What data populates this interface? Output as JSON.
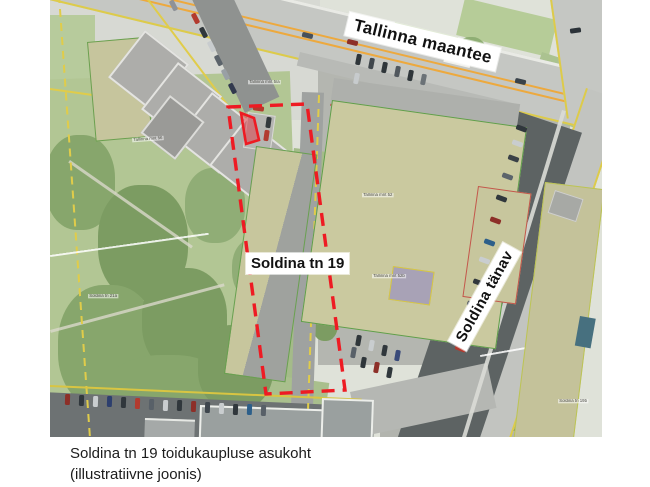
{
  "map": {
    "street_labels": {
      "tallinna_maantee": "Tallinna maantee",
      "soldina_tanav": "Soldina tänav"
    },
    "site_label": "Soldina tn 19",
    "tiny_labels": [
      {
        "text": "Tallinna mnt 5/a",
        "x": 198,
        "y": 80,
        "r": 0
      },
      {
        "text": "Tallinna mnt 56",
        "x": 82,
        "y": 138,
        "r": -4
      },
      {
        "text": "Tallinna mnt 52",
        "x": 312,
        "y": 193,
        "r": 0
      },
      {
        "text": "Tallinna mnt 52b",
        "x": 322,
        "y": 274,
        "r": 0
      },
      {
        "text": "Soldina tn 21a",
        "x": 38,
        "y": 294,
        "r": 0
      },
      {
        "text": "Soldina tn 19b",
        "x": 508,
        "y": 399,
        "r": 0
      }
    ],
    "annotation": {
      "outline_color": "#ee1b23",
      "outline_points": "178,107 257,104 295,390 216,394",
      "shop_points": "191,113 204,118 209,140 196,144",
      "shop_fill": "rgba(231,30,45,0.42)"
    },
    "palette": {
      "park_green": "#b2c694",
      "roof_khaki": "#c9c79e",
      "road_grey": "#c5c7c3",
      "cadastral_yellow": "#ddcb4a",
      "highway_centerline": "#eda93e"
    }
  },
  "caption": {
    "line1": "Soldina tn 19 toidukaupluse asukoht",
    "line2": "(illustratiivne joonis)"
  }
}
